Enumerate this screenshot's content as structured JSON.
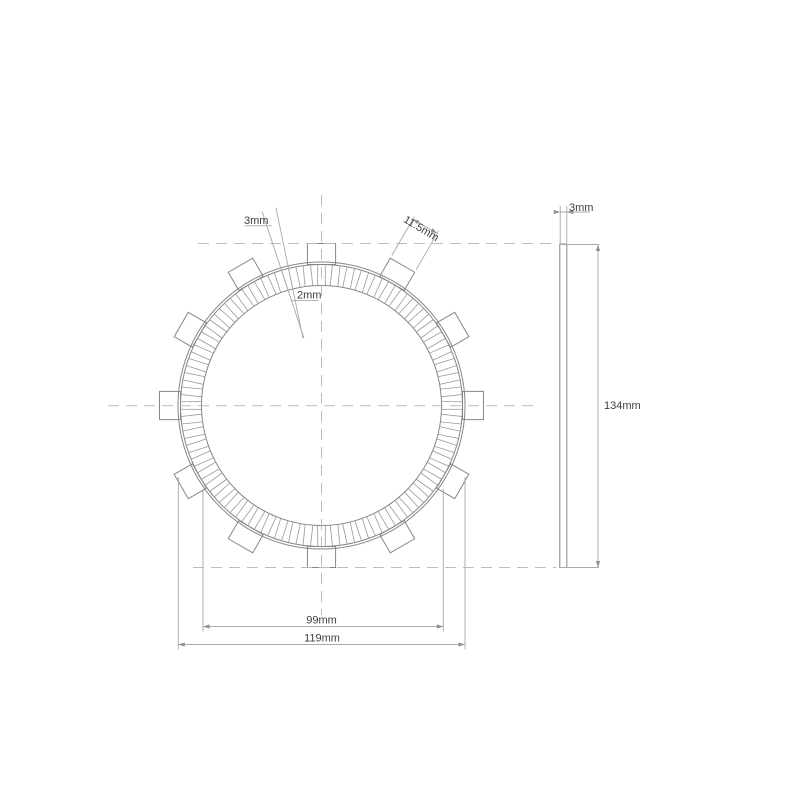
{
  "page": {
    "background": "#ffffff"
  },
  "drawing": {
    "type": "technical-drawing",
    "subject": "clutch friction plate, front view and side view",
    "colors": {
      "outline": "#868686",
      "segment_line": "#999999",
      "centerline": "#bcbcbc",
      "dimension_line": "#a9a9a9",
      "arrow": "#909090",
      "text": "#3d3d3d"
    },
    "labels": {
      "groove_width_outer": "3mm",
      "groove_width_inner": "2mm",
      "tab_width": "11.5mm",
      "plate_thickness": "3mm",
      "friction_inner_diameter": "99mm",
      "friction_outer_diameter": "119mm",
      "overall_diameter": "134mm"
    },
    "geometry": {
      "px_per_mm": 2.42,
      "front": {
        "cx": 321.5,
        "cy": 405.5,
        "r_inner": 120,
        "r_friction_outer": 141,
        "r_plate_outer": 143.5,
        "r_tab_outer": 162,
        "tab_count": 12,
        "tab_width_px": 28.2,
        "groove_count": 60,
        "groove_offset_deg": 3,
        "groove_half_angle_inner_deg": 1.156,
        "groove_half_angle_outer_deg": 1.475,
        "dimensioned_groove_angle_deg": -15
      },
      "side": {
        "x": 559.8,
        "width": 7,
        "top": 244,
        "bottom": 567.5
      }
    }
  }
}
